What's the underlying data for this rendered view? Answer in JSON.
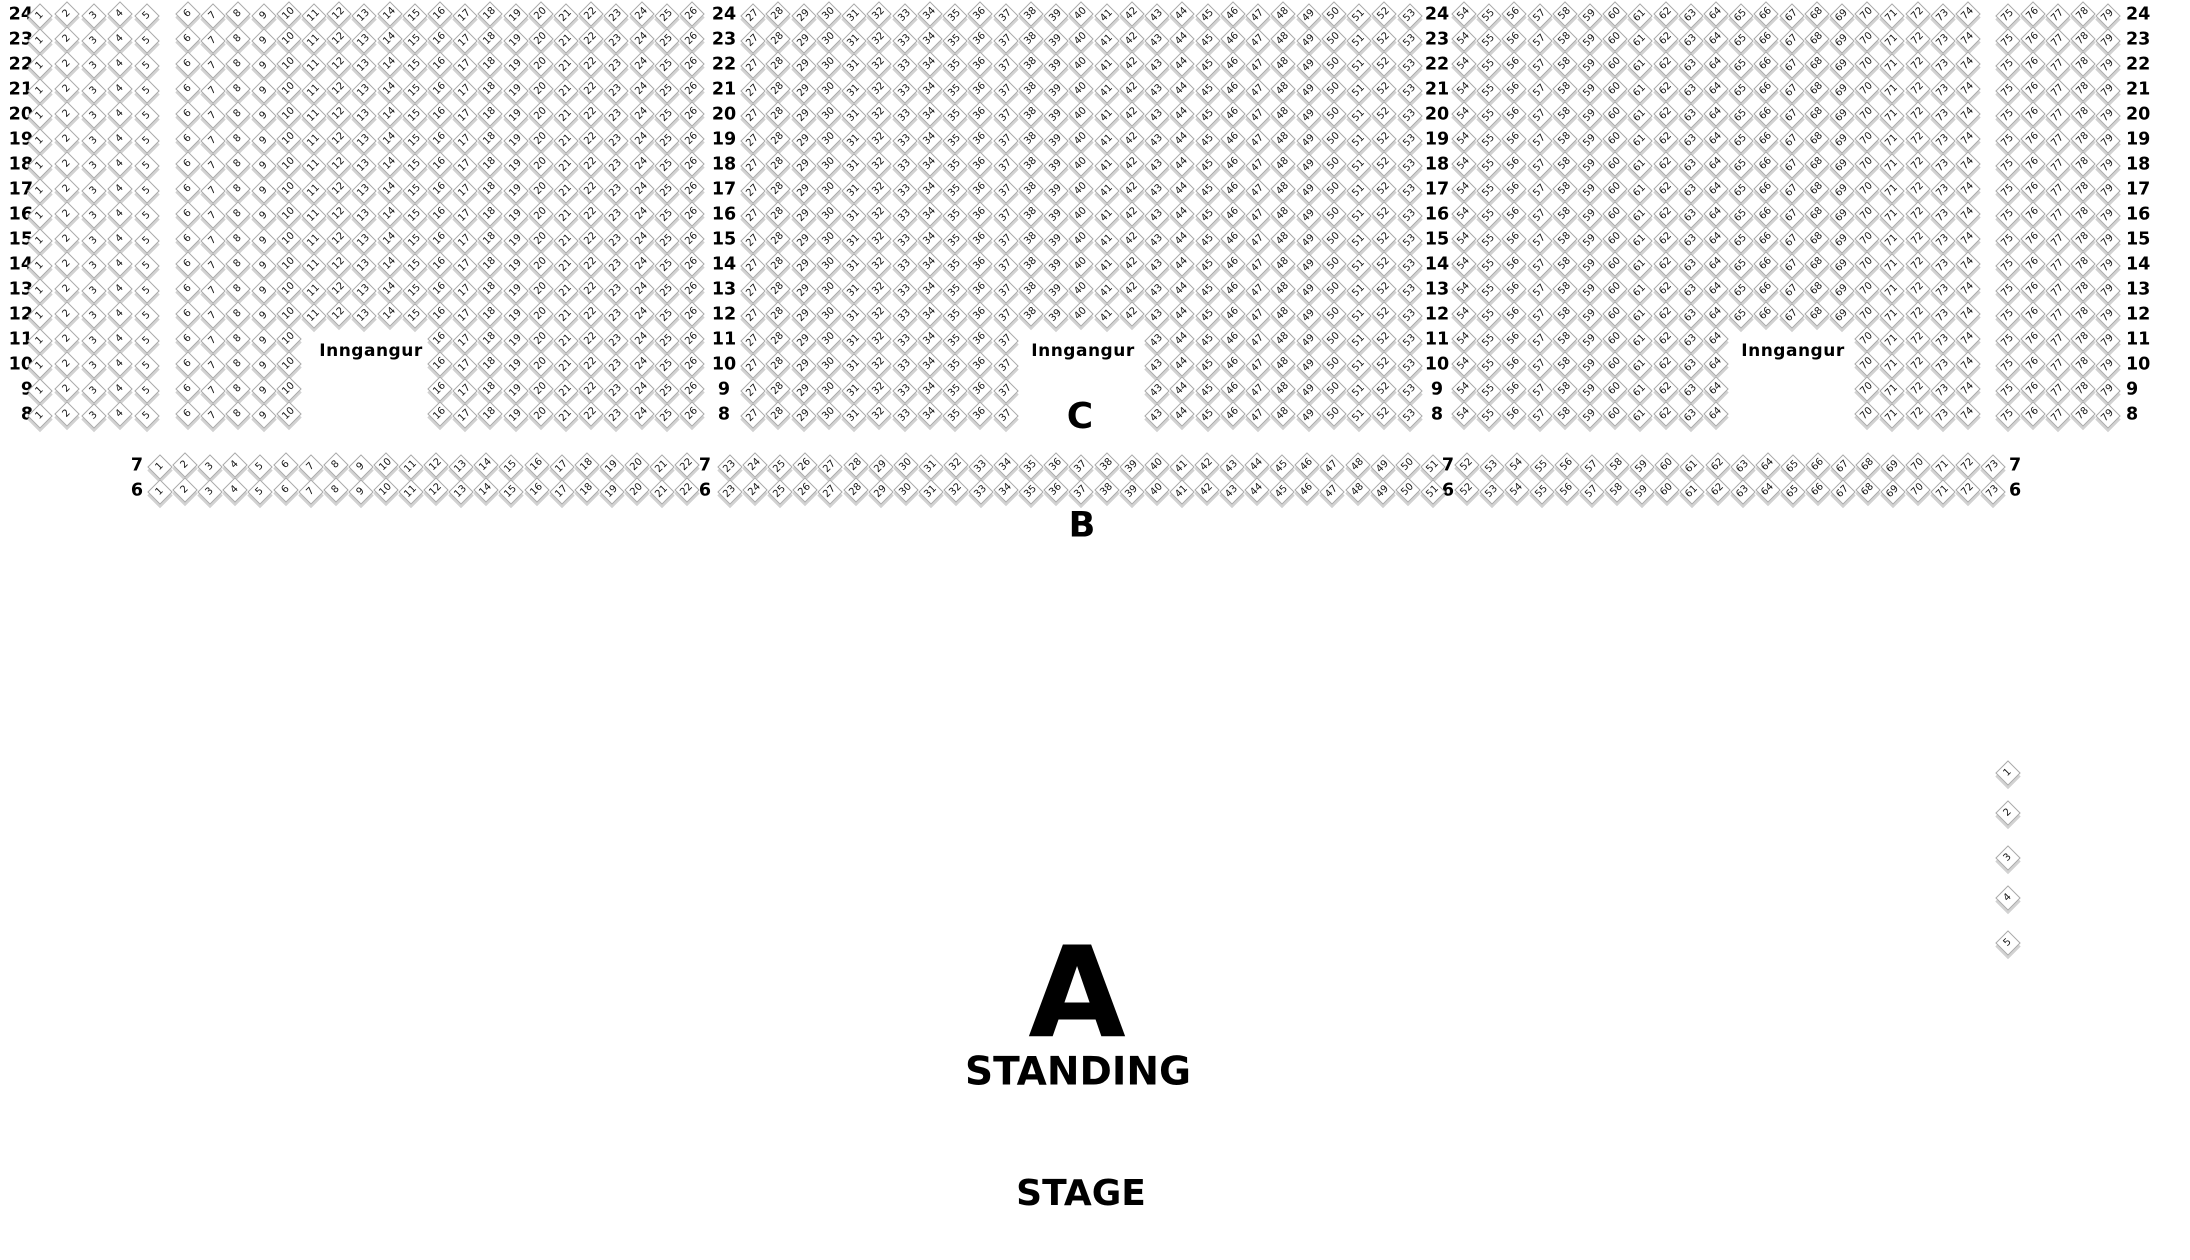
{
  "colors": {
    "seat_fill": "#ffffff",
    "seat_border": "#a8a8a8",
    "seat_shadow": "#d2d2d2",
    "text": "#000000"
  },
  "labels": {
    "entrance": "Inngangur",
    "section_a": "A",
    "section_b": "B",
    "section_c": "C",
    "standing": "STANDING",
    "stage": "STAGE"
  },
  "seatmap": {
    "upper": {
      "rows": [
        24,
        23,
        22,
        21,
        20,
        19,
        18,
        17,
        16,
        15,
        14,
        13,
        12,
        11,
        10,
        9,
        8
      ],
      "blocks": [
        [
          1,
          5
        ],
        [
          6,
          26
        ],
        [
          27,
          53
        ],
        [
          54,
          74
        ],
        [
          75,
          79
        ]
      ],
      "entrance_rows": [
        11,
        10,
        9,
        8
      ],
      "entrance_gaps": [
        [
          11,
          15
        ],
        [
          38,
          42
        ],
        [
          65,
          69
        ]
      ]
    },
    "lower": {
      "rows": [
        7,
        6
      ],
      "blocks": [
        [
          1,
          22
        ],
        [
          23,
          51
        ],
        [
          52,
          73
        ]
      ]
    },
    "side_seats": [
      1,
      2,
      3,
      4,
      5
    ]
  }
}
